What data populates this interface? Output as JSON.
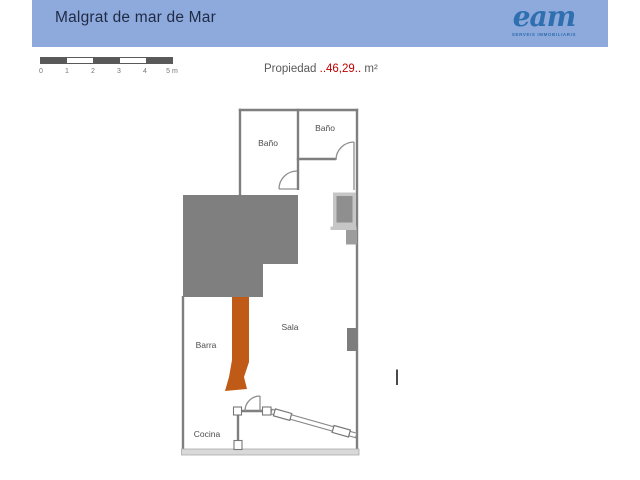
{
  "header": {
    "title": "Malgrat de mar de Mar",
    "logo_text": "eam",
    "logo_subtext": "SERVEIS IMMOBILIARIS"
  },
  "scale_bar": {
    "labels": [
      "0",
      "1",
      "2",
      "3",
      "4",
      "5 m"
    ]
  },
  "property": {
    "prefix": "Propiedad ",
    "area_value": "..46,29..",
    "suffix": " m²"
  },
  "floorplan": {
    "rooms": [
      {
        "id": "bano-left",
        "label": "Baño"
      },
      {
        "id": "bano-right",
        "label": "Baño"
      },
      {
        "id": "sala",
        "label": "Sala"
      },
      {
        "id": "barra",
        "label": "Barra"
      },
      {
        "id": "cocina",
        "label": "Cocina"
      }
    ],
    "colors": {
      "wall": "#7f7f7f",
      "mass": "#7f7f7f",
      "bar": "#bf5b16",
      "window_frame": "#c6c6c6",
      "window_fill": "#8f8f8f",
      "header_band": "#8ea9db",
      "area_red": "#c00000"
    }
  }
}
